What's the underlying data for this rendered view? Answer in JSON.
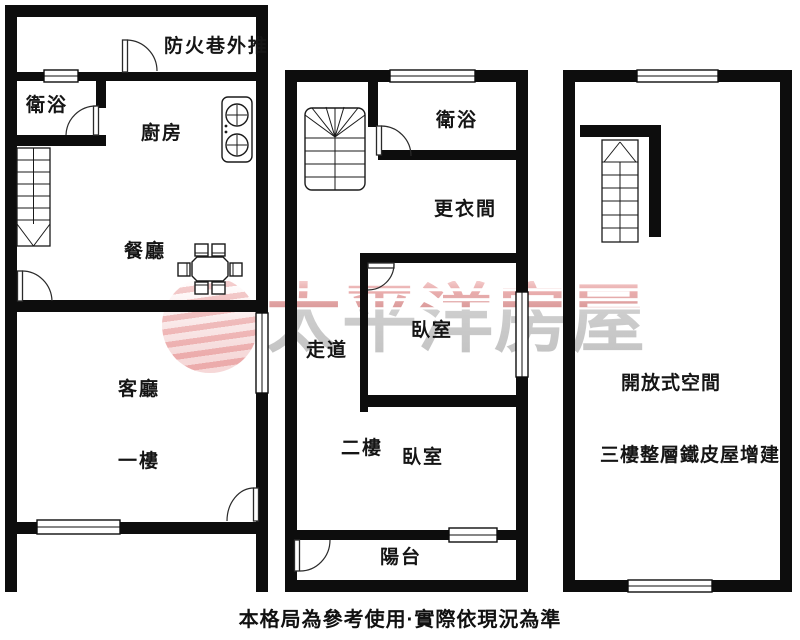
{
  "brand": {
    "watermark_text": "太平洋房屋",
    "logo": "pacific-wave-globe"
  },
  "footer": {
    "disclaimer": "本格局為參考使用·實際依現況為準"
  },
  "colors": {
    "wall": "#0d0d0d",
    "label_text": "#151515",
    "watermark_pink": "#e8a6a6",
    "watermark_gray": "#bdbdbd",
    "logo_pink": "#db6060"
  },
  "floor1": {
    "labels": {
      "fire_lane": "防火巷外推",
      "bathroom": "衛浴",
      "kitchen": "廚房",
      "dining": "餐廳",
      "living": "客廳",
      "floor_name": "一樓"
    }
  },
  "floor2": {
    "labels": {
      "bathroom": "衛浴",
      "dressing": "更衣間",
      "corridor": "走道",
      "bedroom_upper": "臥室",
      "floor_name": "二樓",
      "bedroom_lower": "臥室",
      "balcony": "陽台"
    }
  },
  "floor3": {
    "labels": {
      "open_space": "開放式空間",
      "note": "三樓整層鐵皮屋增建"
    }
  }
}
